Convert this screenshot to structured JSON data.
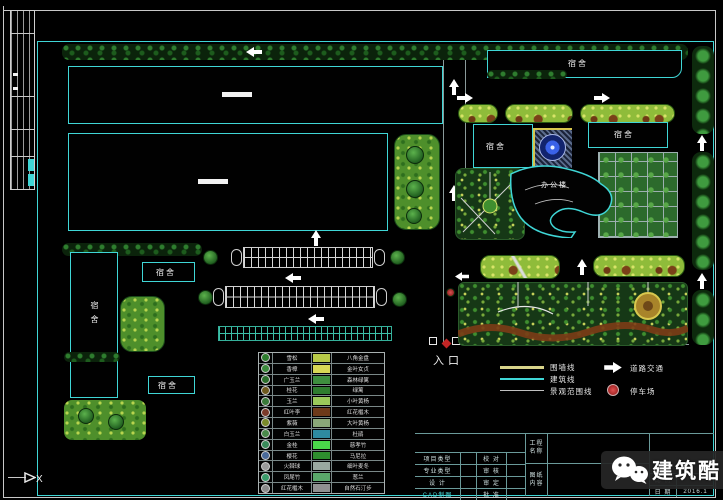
{
  "colors": {
    "background": "#000000",
    "frame_cyan": "#3fd6d6",
    "frame_white": "#c8c8c8",
    "wall_line_yellow": "#d8d48a",
    "building_line_cyan": "#3fd6d6",
    "scope_line_grey": "#c0c0c0",
    "parking_red": "#c03030",
    "fountain_blue": "#3a62e8",
    "path_brown": "#7c3c16",
    "hedge_green": "#0b230b",
    "lawn_green": "#4e8f2b"
  },
  "labels": {
    "dorm": "宿舍",
    "office": "办公楼",
    "entrance": "入口",
    "corner_mark": "X"
  },
  "line_legend": {
    "items": [
      {
        "label": "围墙线",
        "color": "#d8d48a"
      },
      {
        "label": "建筑线",
        "color": "#3fd6d6"
      },
      {
        "label": "景观范围线",
        "color": "#c0c0c0"
      }
    ],
    "road_label": "道路交通",
    "parking_label": "停车场"
  },
  "plant_legend": {
    "rows": [
      {
        "left": "雪松",
        "right": "八角金盘",
        "icon_color": "#2e7d2e",
        "swatch_color": "#b8c948"
      },
      {
        "left": "香樟",
        "right": "金叶女贞",
        "icon_color": "#3c8a3c",
        "swatch_color": "#d8d855"
      },
      {
        "left": "广玉兰",
        "right": "森林绿篱",
        "icon_color": "#2a6e2a",
        "swatch_color": "#3e8e3e"
      },
      {
        "left": "桂花",
        "right": "绿篱",
        "icon_color": "#6e5a1e",
        "swatch_color": "#2f7d2f"
      },
      {
        "left": "玉兰",
        "right": "小叶黄杨",
        "icon_color": "#3a7a3a",
        "swatch_color": "#9ac95a"
      },
      {
        "left": "红叶李",
        "right": "红花檵木",
        "icon_color": "#7a3a2a",
        "swatch_color": "#6e3a1a"
      },
      {
        "left": "紫薇",
        "right": "大叶黄杨",
        "icon_color": "#7a8a2a",
        "swatch_color": "#8aa878"
      },
      {
        "left": "白玉兰",
        "right": "杜鹃",
        "icon_color": "#4a8a4a",
        "swatch_color": "#2e8aa0"
      },
      {
        "left": "金桂",
        "right": "慈孝竹",
        "icon_color": "#3a8a5a",
        "swatch_color": "#4ad84a"
      },
      {
        "left": "樱花",
        "right": "马尼拉",
        "icon_color": "#4a6a9a",
        "swatch_color": "#2e8e2e"
      },
      {
        "left": "火棘球",
        "right": "细叶麦冬",
        "icon_color": "#9a9a9a",
        "swatch_color": "#9aa8a0"
      },
      {
        "left": "凤尾竹",
        "right": "葱兰",
        "icon_color": "#3a9a6a",
        "swatch_color": "#5aa86a"
      },
      {
        "left": "红花檵木",
        "right": "自然石汀步",
        "icon_color": "#8a8a8a",
        "swatch_color": "#909090"
      }
    ]
  },
  "title_block": {
    "rows": [
      {
        "c1": "项目类型",
        "c2": "校 对"
      },
      {
        "c1": "专业类型",
        "c2": "审 核"
      },
      {
        "c1": "设  计",
        "c2": "审 定"
      },
      {
        "c1": "CAD制图",
        "c2": "批 准"
      }
    ],
    "project_label": "工程名称",
    "sheet_label": "图纸内容",
    "scale_label": "比 例",
    "date_label": "日 期",
    "date_value": "2016.1"
  },
  "watermark": {
    "brand": "建筑酷"
  }
}
